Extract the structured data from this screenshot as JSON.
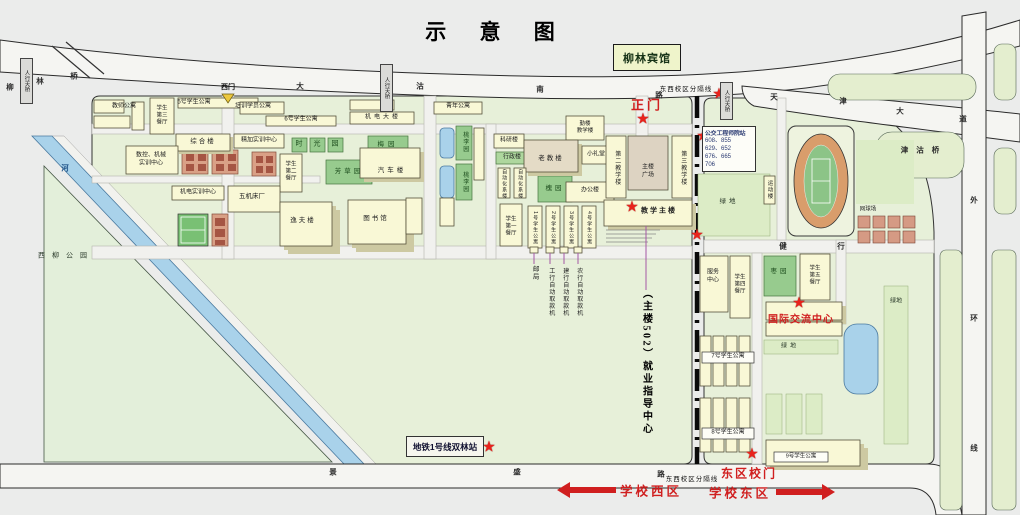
{
  "title": "示 意 图",
  "colors": {
    "accent_red": "#d01f1f",
    "star_red": "#e8231c",
    "campus_green": "#e7f0d9",
    "garden_green": "#97cb8e",
    "water_blue": "#a9d2ea",
    "building_yellow": "#f9f8d6",
    "dorm_red": "#d9a086",
    "divider_black": "#111111",
    "bus_text_blue": "#2a3a72"
  },
  "icons": {
    "star": "★",
    "gate_triangle": "▼"
  },
  "hotel": {
    "label": "柳林宾馆"
  },
  "metro_station": {
    "label": "地铁1号线双林站"
  },
  "bus_stop": {
    "title": "公交工程师院站",
    "lines": [
      "608、855",
      "629、652",
      "676、665",
      "706"
    ]
  },
  "gates": {
    "west": "西门",
    "main": "正门",
    "east": "东区校门"
  },
  "zones": {
    "west": "学校西区",
    "east": "学校东区",
    "divider": "东西校区分隔线"
  },
  "notes": {
    "employment": "（主楼502）就业指导中心"
  },
  "special": {
    "intl_center": "国际交流中心",
    "park": "西柳公园"
  },
  "map_labels": [
    {
      "id": "label-teacher-apartment",
      "t": "教师公寓",
      "x": 124,
      "y": 107,
      "s": 6
    },
    {
      "id": "label-dining-hall-3",
      "t": "学生\n第三\n餐厅",
      "x": 162,
      "y": 116,
      "s": 5.5
    },
    {
      "id": "label-apartment-5",
      "t": "5号学生公寓",
      "x": 194,
      "y": 103,
      "s": 6
    },
    {
      "id": "label-trainee-apartment",
      "t": "培训学员公寓",
      "x": 253,
      "y": 107,
      "s": 6
    },
    {
      "id": "label-apartment-6",
      "t": "6号学生公寓",
      "x": 301,
      "y": 120,
      "s": 6
    },
    {
      "id": "label-jidian-building",
      "t": "机电大楼",
      "x": 383,
      "y": 118,
      "s": 6,
      "ls": 3
    },
    {
      "id": "label-youth-apartment",
      "t": "青年公寓",
      "x": 458,
      "y": 107,
      "s": 6
    },
    {
      "id": "label-zonghe-building",
      "t": "综合楼",
      "x": 203,
      "y": 142,
      "s": 6.5,
      "ls": 2
    },
    {
      "id": "label-precision-training-center",
      "t": "精加实训中心",
      "x": 259,
      "y": 141,
      "s": 6
    },
    {
      "id": "label-cnc-training-center",
      "t": "数控、机械\n实训中心",
      "x": 151,
      "y": 160,
      "s": 6
    },
    {
      "id": "label-dining-hall-2",
      "t": "学生\n第二\n餐厅",
      "x": 291,
      "y": 172,
      "s": 5.5
    },
    {
      "id": "label-garden-shi",
      "t": "时",
      "x": 299,
      "y": 145,
      "s": 7,
      "c": "#1d4d1d"
    },
    {
      "id": "label-garden-guang",
      "t": "光",
      "x": 317,
      "y": 145,
      "s": 7,
      "c": "#1d4d1d"
    },
    {
      "id": "label-garden-yuan",
      "t": "园",
      "x": 335,
      "y": 145,
      "s": 7,
      "c": "#1d4d1d"
    },
    {
      "id": "label-mei-garden",
      "t": "梅园",
      "x": 388,
      "y": 145,
      "s": 6.5,
      "ls": 4,
      "c": "#1d4d1d"
    },
    {
      "id": "label-fangcao-garden",
      "t": "芳草园",
      "x": 349,
      "y": 172,
      "s": 6.5,
      "ls": 3,
      "c": "#1d4d1d"
    },
    {
      "id": "label-auto-building",
      "t": "汽车楼",
      "x": 392,
      "y": 171,
      "s": 6.5,
      "ls": 3
    },
    {
      "id": "label-taoli-garden-north",
      "t": "桃李园",
      "x": 464,
      "y": 142,
      "v": true,
      "s": 6,
      "c": "#1d4d1d"
    },
    {
      "id": "label-taoli-garden-south",
      "t": "桃李园",
      "x": 464,
      "y": 182,
      "v": true,
      "s": 6,
      "c": "#1d4d1d"
    },
    {
      "id": "label-electromech-training-center",
      "t": "机电实训中心",
      "x": 198,
      "y": 193,
      "s": 6
    },
    {
      "id": "label-machine-tool-factory",
      "t": "五机床厂",
      "x": 252,
      "y": 197,
      "s": 6.5
    },
    {
      "id": "label-yifu-building",
      "t": "逸夫楼",
      "x": 303,
      "y": 221,
      "s": 6.5,
      "ls": 2
    },
    {
      "id": "label-library",
      "t": "图书馆",
      "x": 376,
      "y": 219,
      "s": 6.5,
      "ls": 2
    },
    {
      "id": "label-old-teaching-building",
      "t": "老教楼",
      "x": 551,
      "y": 159,
      "s": 6.5,
      "ls": 2
    },
    {
      "id": "label-small-auditorium",
      "t": "小礼堂",
      "x": 596,
      "y": 155,
      "s": 6
    },
    {
      "id": "label-qinlou-teaching-building",
      "t": "勤楼\n教学楼",
      "x": 585,
      "y": 128,
      "s": 5.5
    },
    {
      "id": "label-research-building",
      "t": "科研楼",
      "x": 509,
      "y": 141,
      "s": 6
    },
    {
      "id": "label-admin-building",
      "t": "行政楼",
      "x": 512,
      "y": 158,
      "s": 6
    },
    {
      "id": "label-automation-building-1",
      "t": "自动化系楼",
      "x": 504,
      "y": 184,
      "v": true,
      "s": 5
    },
    {
      "id": "label-automation-building-2",
      "t": "自动化系楼",
      "x": 520,
      "y": 184,
      "v": true,
      "s": 5
    },
    {
      "id": "label-huai-garden",
      "t": "槐园",
      "x": 555,
      "y": 189,
      "s": 6.5,
      "ls": 3,
      "c": "#1d4d1d"
    },
    {
      "id": "label-office-building",
      "t": "办公楼",
      "x": 590,
      "y": 191,
      "s": 6
    },
    {
      "id": "label-main-building-square",
      "t": "主楼\n广场",
      "x": 648,
      "y": 172,
      "s": 6
    },
    {
      "id": "label-teaching-building-2",
      "t": "第二教学楼",
      "x": 616,
      "y": 168,
      "v": true,
      "s": 6
    },
    {
      "id": "label-teaching-building-3",
      "t": "第三教学楼",
      "x": 682,
      "y": 168,
      "v": true,
      "s": 6
    },
    {
      "id": "label-main-teaching-building",
      "t": "教学主楼",
      "x": 659,
      "y": 212,
      "s": 7,
      "b": true,
      "ls": 2
    },
    {
      "id": "label-dining-hall-1",
      "t": "学生\n第一\n餐厅",
      "x": 511,
      "y": 227,
      "s": 5.5
    },
    {
      "id": "label-apartment-1",
      "t": "1号学生公寓",
      "x": 535,
      "y": 228,
      "v": true,
      "s": 5
    },
    {
      "id": "label-apartment-2",
      "t": "2号学生公寓",
      "x": 553,
      "y": 228,
      "v": true,
      "s": 5
    },
    {
      "id": "label-apartment-3",
      "t": "3号学生公寓",
      "x": 571,
      "y": 228,
      "v": true,
      "s": 5
    },
    {
      "id": "label-apartment-4",
      "t": "4号学生公寓",
      "x": 589,
      "y": 228,
      "v": true,
      "s": 5
    },
    {
      "id": "label-post-office",
      "t": "邮局",
      "x": 534,
      "y": 273,
      "v": true,
      "s": 6.5
    },
    {
      "id": "label-icbc-atm",
      "t": "工行自动取款机",
      "x": 550,
      "y": 292,
      "v": true,
      "s": 6
    },
    {
      "id": "label-ccb-atm",
      "t": "建行自动取款机",
      "x": 564,
      "y": 292,
      "v": true,
      "s": 6
    },
    {
      "id": "label-abc-atm",
      "t": "农行自动取款机",
      "x": 578,
      "y": 292,
      "v": true,
      "s": 6
    },
    {
      "id": "label-xiliu-park",
      "t": "西柳公园",
      "x": 66,
      "y": 257,
      "s": 7,
      "ls": 7,
      "c": "#2a3a2a"
    },
    {
      "id": "label-green-space-1",
      "t": "绿地",
      "x": 729,
      "y": 202,
      "s": 6.5,
      "ls": 3,
      "c": "#2a3a2a"
    },
    {
      "id": "label-sports-building",
      "t": "运动楼",
      "x": 769,
      "y": 190,
      "v": true,
      "s": 5.5
    },
    {
      "id": "label-tennis-court",
      "t": "网球场",
      "x": 868,
      "y": 210,
      "s": 5.5
    },
    {
      "id": "label-service-center",
      "t": "服务\n中心",
      "x": 713,
      "y": 277,
      "s": 6
    },
    {
      "id": "label-dining-hall-4",
      "t": "学生\n第四\n餐厅",
      "x": 740,
      "y": 285,
      "s": 5.5
    },
    {
      "id": "label-zao-garden",
      "t": "枣园",
      "x": 780,
      "y": 272,
      "s": 6.5,
      "ls": 3,
      "c": "#1d4d1d"
    },
    {
      "id": "label-dining-hall-5",
      "t": "学生\n第五\n餐厅",
      "x": 815,
      "y": 276,
      "s": 5.5
    },
    {
      "id": "label-apartment-7",
      "t": "7号学生公寓",
      "x": 728,
      "y": 357,
      "s": 6
    },
    {
      "id": "label-green-space-2",
      "t": "绿地",
      "x": 790,
      "y": 347,
      "s": 6,
      "ls": 3,
      "c": "#2a3a2a"
    },
    {
      "id": "label-apartment-8",
      "t": "8号学生公寓",
      "x": 728,
      "y": 433,
      "s": 6
    },
    {
      "id": "label-apartment-9",
      "t": "9号学生公寓",
      "x": 801,
      "y": 457,
      "s": 5.5
    },
    {
      "id": "label-green-space-3",
      "t": "绿地",
      "x": 896,
      "y": 302,
      "s": 6,
      "c": "#2a3a2a"
    }
  ],
  "road_chars": [
    {
      "id": "road-liulin-bridge-1",
      "t": "柳",
      "x": 10,
      "y": 87
    },
    {
      "id": "road-liulin-bridge-2",
      "t": "林",
      "x": 40,
      "y": 81
    },
    {
      "id": "road-liulin-bridge-3",
      "t": "桥",
      "x": 74,
      "y": 76
    },
    {
      "id": "road-dagu-south-1",
      "t": "大",
      "x": 300,
      "y": 86
    },
    {
      "id": "road-dagu-south-2",
      "t": "沽",
      "x": 420,
      "y": 86
    },
    {
      "id": "road-dagu-south-3",
      "t": "南",
      "x": 540,
      "y": 89
    },
    {
      "id": "road-dagu-south-4",
      "t": "路",
      "x": 659,
      "y": 95
    },
    {
      "id": "road-tianjin-ave-1",
      "t": "天",
      "x": 774,
      "y": 97
    },
    {
      "id": "road-tianjin-ave-2",
      "t": "津",
      "x": 843,
      "y": 101
    },
    {
      "id": "road-tianjin-ave-3",
      "t": "大",
      "x": 900,
      "y": 111
    },
    {
      "id": "road-tianjin-ave-4",
      "t": "道",
      "x": 963,
      "y": 119
    },
    {
      "id": "road-jingu-bridge",
      "t": "津沽桥",
      "x": 924,
      "y": 150,
      "ls": 8
    },
    {
      "id": "road-outer-ring-1",
      "t": "外",
      "x": 974,
      "y": 200
    },
    {
      "id": "road-outer-ring-2",
      "t": "环",
      "x": 974,
      "y": 318
    },
    {
      "id": "road-outer-ring-3",
      "t": "线",
      "x": 974,
      "y": 448
    },
    {
      "id": "road-jingsheng-1",
      "t": "景",
      "x": 333,
      "y": 472
    },
    {
      "id": "road-jingsheng-2",
      "t": "盛",
      "x": 517,
      "y": 472
    },
    {
      "id": "road-jingsheng-3",
      "t": "路",
      "x": 661,
      "y": 474
    },
    {
      "id": "road-jianxing-1",
      "t": "健",
      "x": 783,
      "y": 246
    },
    {
      "id": "road-jianxing-2",
      "t": "行",
      "x": 841,
      "y": 246
    },
    {
      "id": "river-name",
      "t": "河",
      "x": 65,
      "y": 168,
      "c": "#1c4f86"
    }
  ],
  "stars": [
    {
      "id": "star-liulin-hotel",
      "x": 646,
      "y": 66
    },
    {
      "id": "star-main-gate",
      "x": 643,
      "y": 119
    },
    {
      "id": "star-pedestrian-bridge-east",
      "x": 719,
      "y": 94
    },
    {
      "id": "star-bus-stop",
      "x": 703,
      "y": 136
    },
    {
      "id": "star-main-teaching-building",
      "x": 632,
      "y": 207
    },
    {
      "id": "star-divider-crossing",
      "x": 697,
      "y": 235
    },
    {
      "id": "star-intl-exchange-center",
      "x": 799,
      "y": 303
    },
    {
      "id": "star-metro-station",
      "x": 489,
      "y": 447
    },
    {
      "id": "star-east-gate",
      "x": 752,
      "y": 454
    }
  ],
  "bridges": [
    {
      "id": "pedestrian-bridge-west",
      "t": "人行天桥",
      "x": 20,
      "y": 58,
      "h": 46
    },
    {
      "id": "pedestrian-bridge-center",
      "t": "人行天桥",
      "x": 380,
      "y": 64,
      "h": 48
    },
    {
      "id": "pedestrian-bridge-east",
      "t": "人行天桥",
      "x": 720,
      "y": 82,
      "h": 38
    }
  ]
}
